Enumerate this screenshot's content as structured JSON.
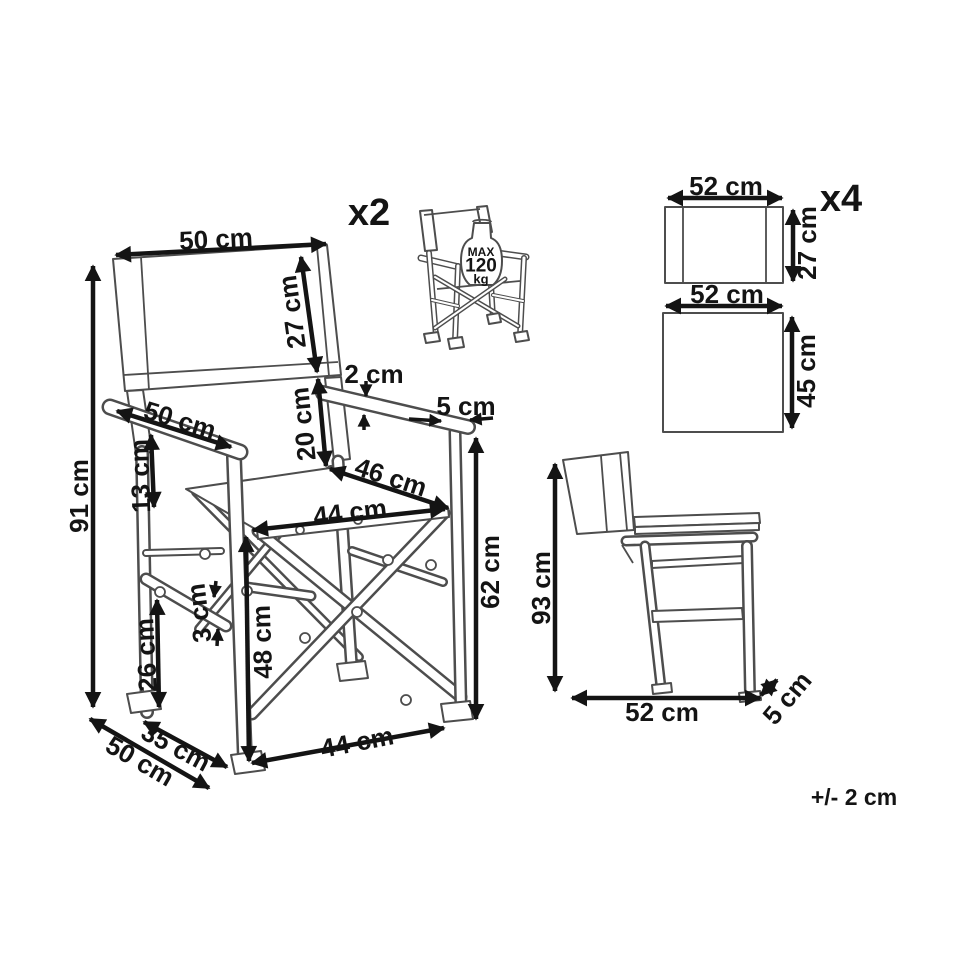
{
  "tolerance_note": "+/- 2 cm",
  "main_view": {
    "quantity_label": "x2",
    "dims": {
      "backrest_width": "50 cm",
      "backrest_height": "27 cm",
      "total_height": "91 cm",
      "armrest_length": "50 cm",
      "armrest_to_seat": "13 cm",
      "armrest_thickness": "2 cm",
      "backrest_to_seat_gap": "20 cm",
      "armrest_end_width": "5 cm",
      "seat_depth": "46 cm",
      "seat_width": "44 cm",
      "armrest_floor_height": "62 cm",
      "seat_floor_height": "48 cm",
      "side_rail_height": "26 cm",
      "side_rail_thickness": "3 cm",
      "leg_stance_depth": "35 cm",
      "overall_depth": "50 cm",
      "front_base_width": "44 cm"
    }
  },
  "load_icon": {
    "line1": "MAX",
    "line2": "120",
    "line3": "kg"
  },
  "fabric_panels": {
    "quantity_label": "x4",
    "backrest_panel": {
      "width": "52 cm",
      "height": "27 cm"
    },
    "seat_panel": {
      "width": "52 cm",
      "height": "45 cm"
    }
  },
  "folded_view": {
    "height": "93 cm",
    "depth": "52 cm",
    "thickness": "5 cm"
  }
}
